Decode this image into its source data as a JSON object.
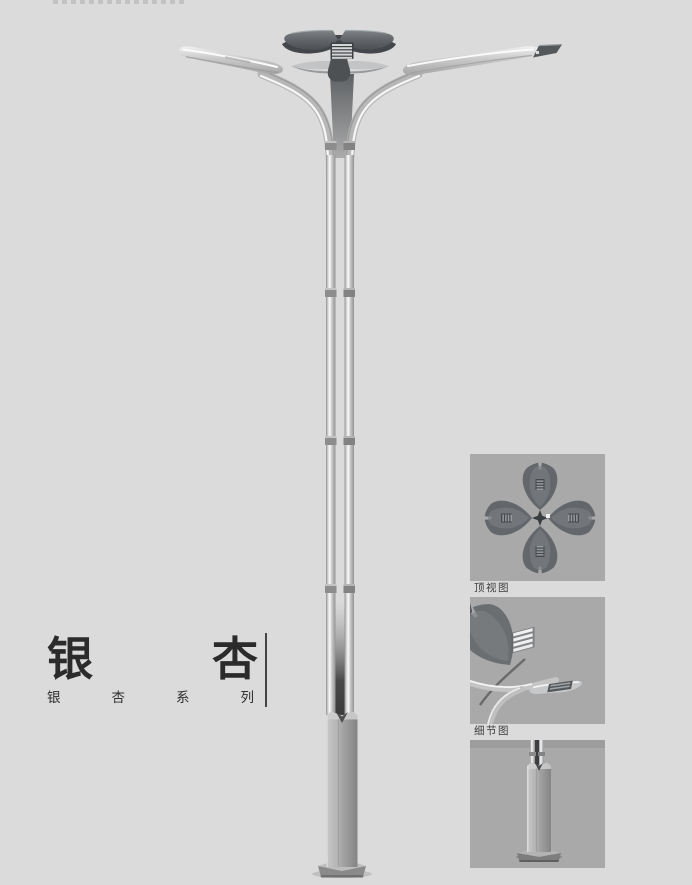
{
  "page": {
    "background": "#dbdbdb"
  },
  "title": {
    "char1": "银",
    "char2": "杏",
    "series": "银杏系列"
  },
  "panels": [
    {
      "id": "top-view",
      "label": "顶视图"
    },
    {
      "id": "detail-view",
      "label": "细节图"
    },
    {
      "id": "base-view",
      "label": ""
    }
  ],
  "colors": {
    "panel_background": "#a9a9a9",
    "title_text": "#2b2b2b",
    "metal_light": "#d8d8d8",
    "metal_dark": "#55585b",
    "pole_highlight": "#fafafa"
  }
}
